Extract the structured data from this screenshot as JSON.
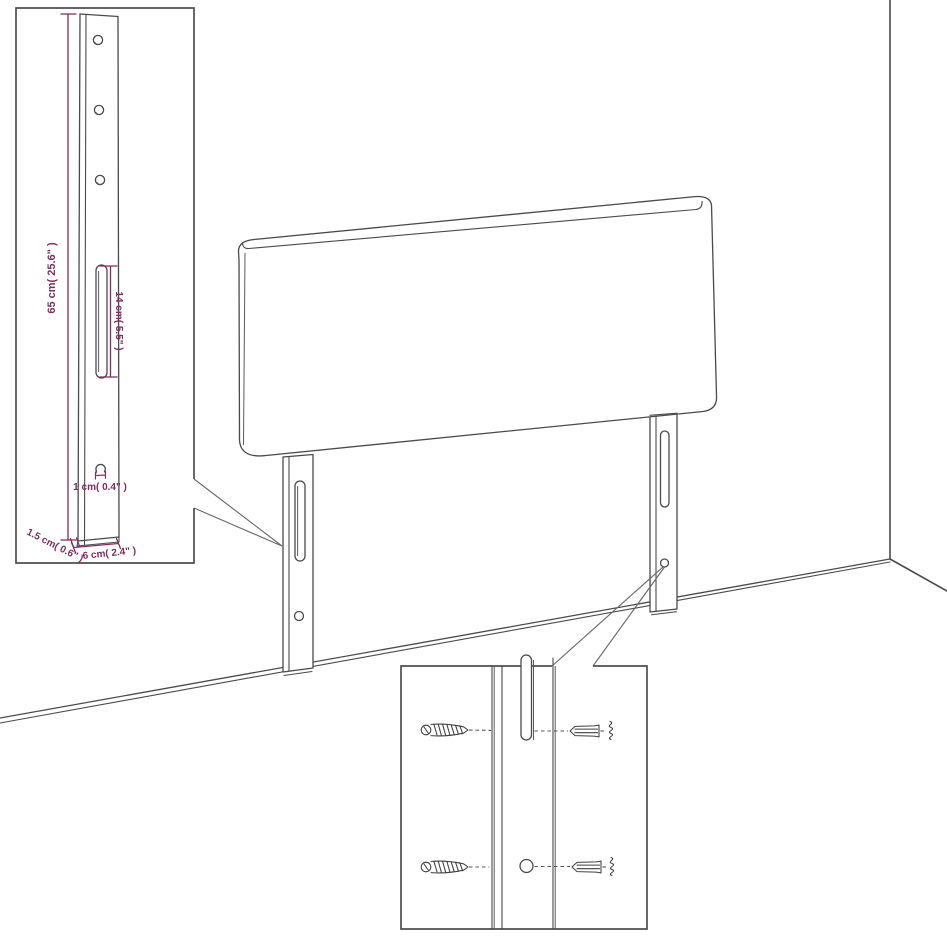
{
  "title": "Headboard wall-mounting dimensions diagram",
  "colors": {
    "line": "#4a4a4a",
    "dimension": "#7e2d5d",
    "box_border": "#4f4f4f",
    "background": "#ffffff"
  },
  "callout_top_left": {
    "dim_leg_height": "65 cm( 25.6\" )",
    "dim_slot_length": "14 cm( 5.5\" )",
    "dim_hole_diameter": "1 cm( 0.4\" )",
    "dim_leg_thickness": "1.5 cm( 0.6\" )",
    "dim_leg_width": "6 cm( 2.4\" )"
  },
  "icons": {
    "screw": "screw-icon",
    "wall_plug": "wall-plug-icon",
    "mounting_slot": "slot-icon",
    "mounting_hole": "hole-icon"
  }
}
